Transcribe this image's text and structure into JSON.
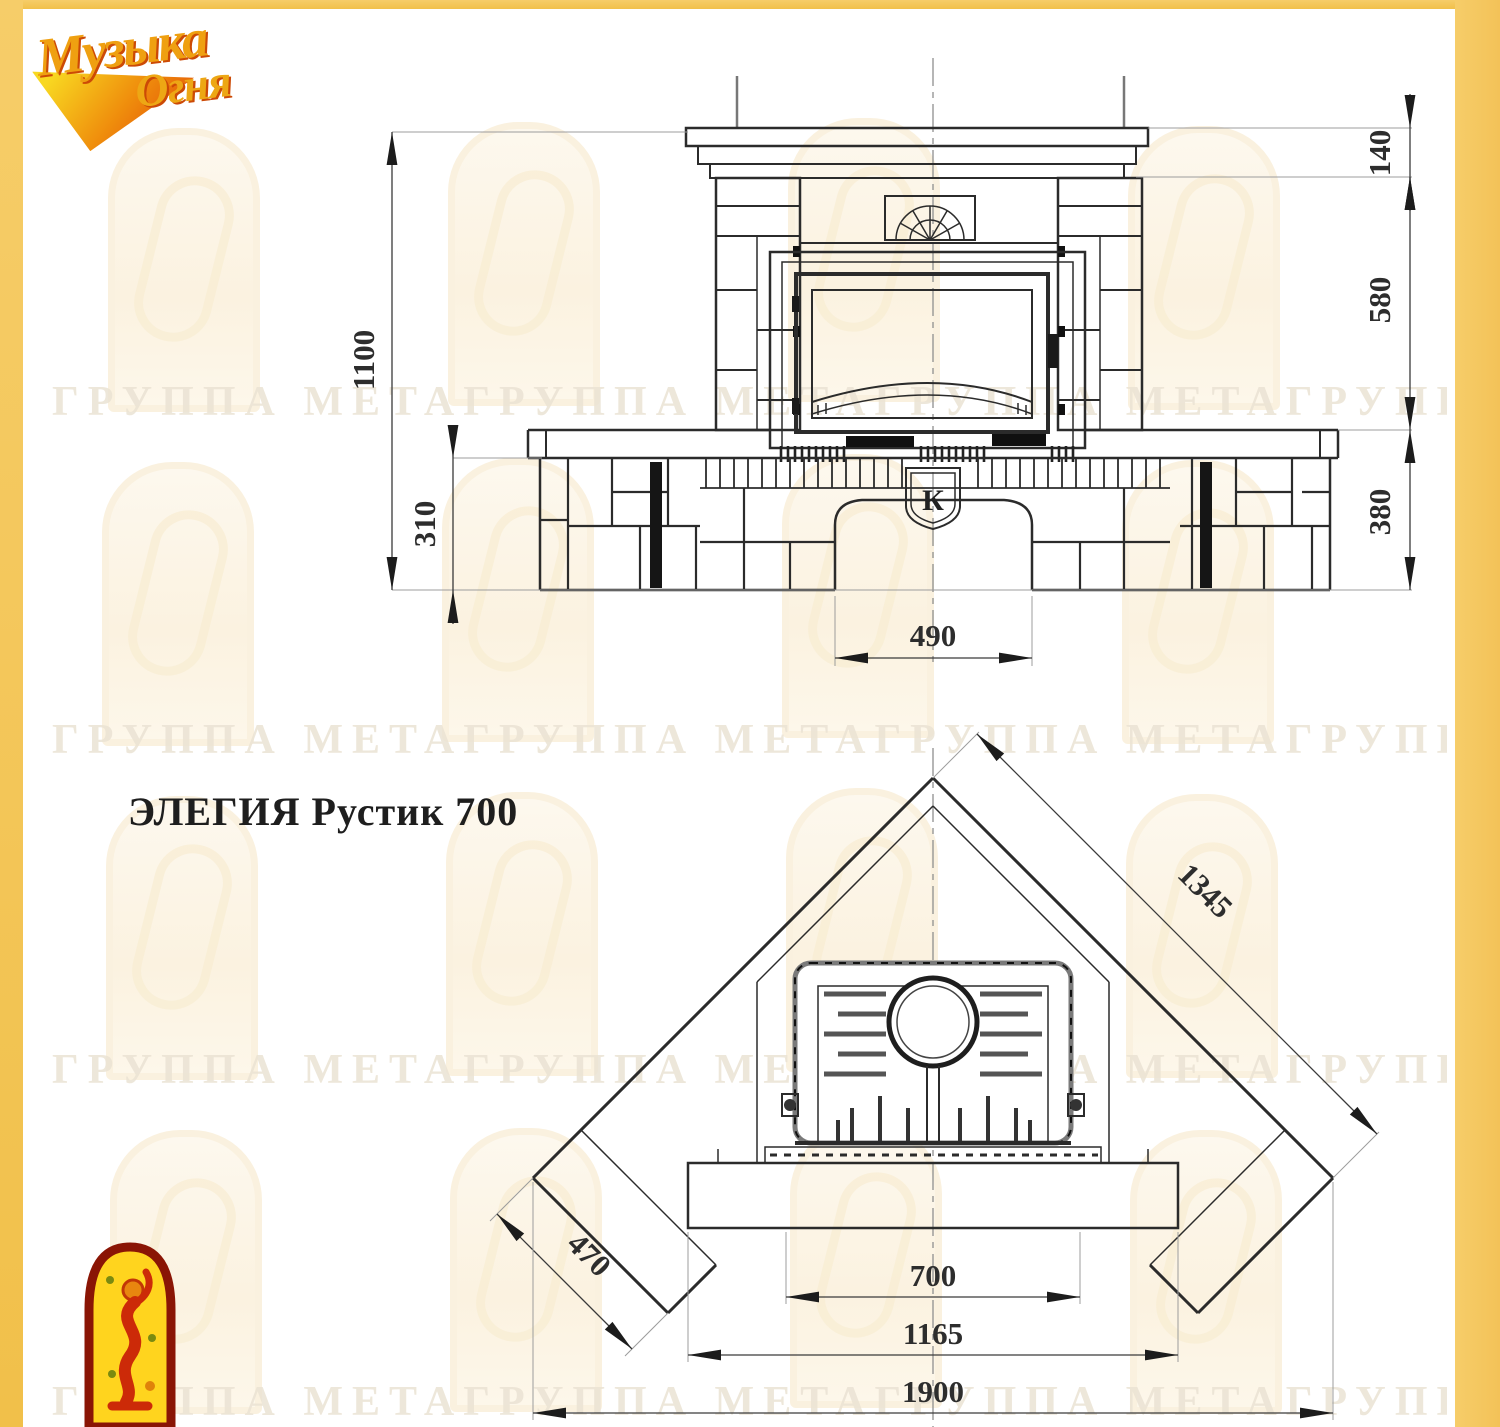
{
  "branding": {
    "logo_top_left_line1": "Музыка",
    "logo_top_left_line2": "Огня"
  },
  "watermark": {
    "text": "ГРУППА МЕТАГРУППА МЕТАГРУППА МЕТАГРУППА МЕТА"
  },
  "title": "ЭЛЕГИЯ Рустик 700",
  "front_view": {
    "dim_total_height": "1100",
    "dim_bench_height": "310",
    "dim_cornice_height": "140",
    "dim_firebox_zone_height": "580",
    "dim_base_height": "380",
    "dim_arch_width": "490",
    "keystone_letter": "К"
  },
  "plan_view": {
    "dim_side_length": "1345",
    "dim_bench_depth": "470",
    "dim_opening_width": "700",
    "dim_base_width": "1165",
    "dim_total_width": "1900"
  }
}
